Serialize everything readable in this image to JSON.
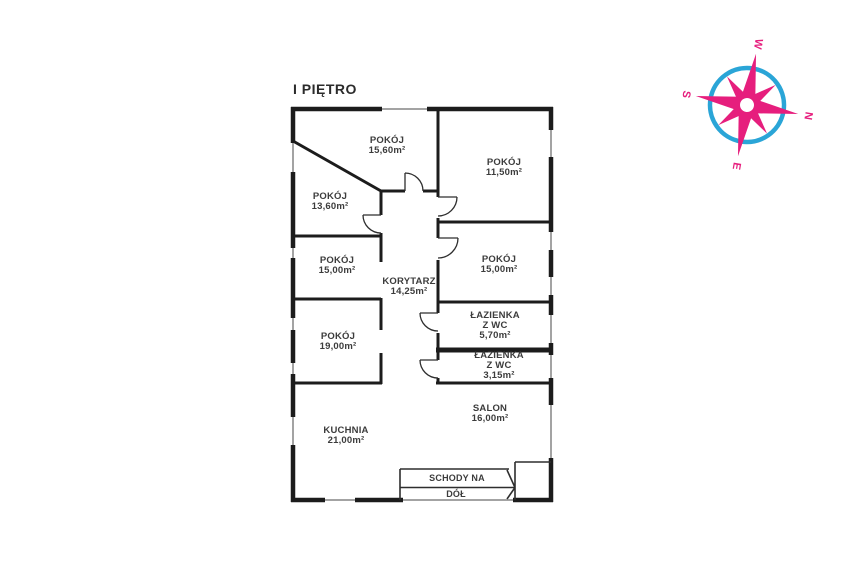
{
  "title": "I PIĘTRO",
  "colors": {
    "wall": "#1c1c1c",
    "window": "#a3a3a3",
    "label": "#3c3c3c",
    "compass_blue": "#2aa5d7",
    "compass_pink": "#e61e7d"
  },
  "rooms": [
    {
      "name": "POKÓJ",
      "area": "15,60m²"
    },
    {
      "name": "POKÓJ",
      "area": "11,50m²"
    },
    {
      "name": "POKÓJ",
      "area": "13,60m²"
    },
    {
      "name": "POKÓJ",
      "area": "15,00m²"
    },
    {
      "name": "KORYTARZ",
      "area": "14,25m²"
    },
    {
      "name": "POKÓJ",
      "area": "15,00m²"
    },
    {
      "name": "ŁAZIENKA",
      "line2": "Z WC",
      "area": "5,70m²"
    },
    {
      "name": "ŁAZIENKA",
      "line2": "Z WC",
      "area": "3,15m²"
    },
    {
      "name": "POKÓJ",
      "area": "19,00m²"
    },
    {
      "name": "KUCHNIA",
      "area": "21,00m²"
    },
    {
      "name": "SALON",
      "area": "16,00m²"
    }
  ],
  "stairs": {
    "line1": "SCHODY NA",
    "line2": "DÓŁ"
  },
  "compass": {
    "n": "N",
    "s": "S",
    "e": "E",
    "w": "W"
  }
}
